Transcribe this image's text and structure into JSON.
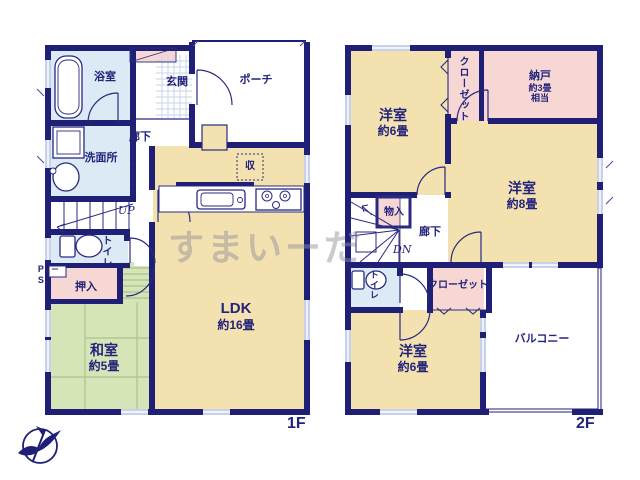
{
  "watermark": "すまいーだ",
  "colors": {
    "wall": "#1f1f76",
    "room_cream": "#f3e1b0",
    "room_green": "#d5e5b8",
    "room_pink": "#f7d7d4",
    "room_blue": "#dbeaf5",
    "window": "#c7d2ea",
    "text": "#23237b"
  },
  "floor1": {
    "tag": "1F",
    "rooms": {
      "bath": {
        "label": "浴室"
      },
      "entrance": {
        "label": "玄関"
      },
      "porch": {
        "label": "ポーチ"
      },
      "corridor": {
        "label": "廊下"
      },
      "washroom": {
        "label": "洗面所"
      },
      "stairs": {
        "label": "UP"
      },
      "toilet": {
        "label": "トイレ"
      },
      "ps": {
        "label": "PS"
      },
      "oshiire": {
        "label": "押入"
      },
      "washitsu": {
        "label": "和室",
        "size": "約5畳"
      },
      "ldk": {
        "label": "LDK",
        "size": "約16畳"
      },
      "storage": {
        "label": "収"
      }
    }
  },
  "floor2": {
    "tag": "2F",
    "rooms": {
      "bedroom6a": {
        "label": "洋室",
        "size": "約6畳"
      },
      "closet_top": {
        "label": "クローゼット"
      },
      "nando": {
        "label": "納戸",
        "size": "約3畳",
        "size2": "相当"
      },
      "bedroom8": {
        "label": "洋室",
        "size": "約8畳"
      },
      "monoire": {
        "label": "物入"
      },
      "corridor": {
        "label": "廊下"
      },
      "stairs": {
        "label": "DN"
      },
      "toilet": {
        "label": "トイレ"
      },
      "closet_bottom": {
        "label": "クローゼット"
      },
      "bedroom6b": {
        "label": "洋室",
        "size": "約6畳"
      },
      "balcony": {
        "label": "バルコニー"
      }
    }
  }
}
